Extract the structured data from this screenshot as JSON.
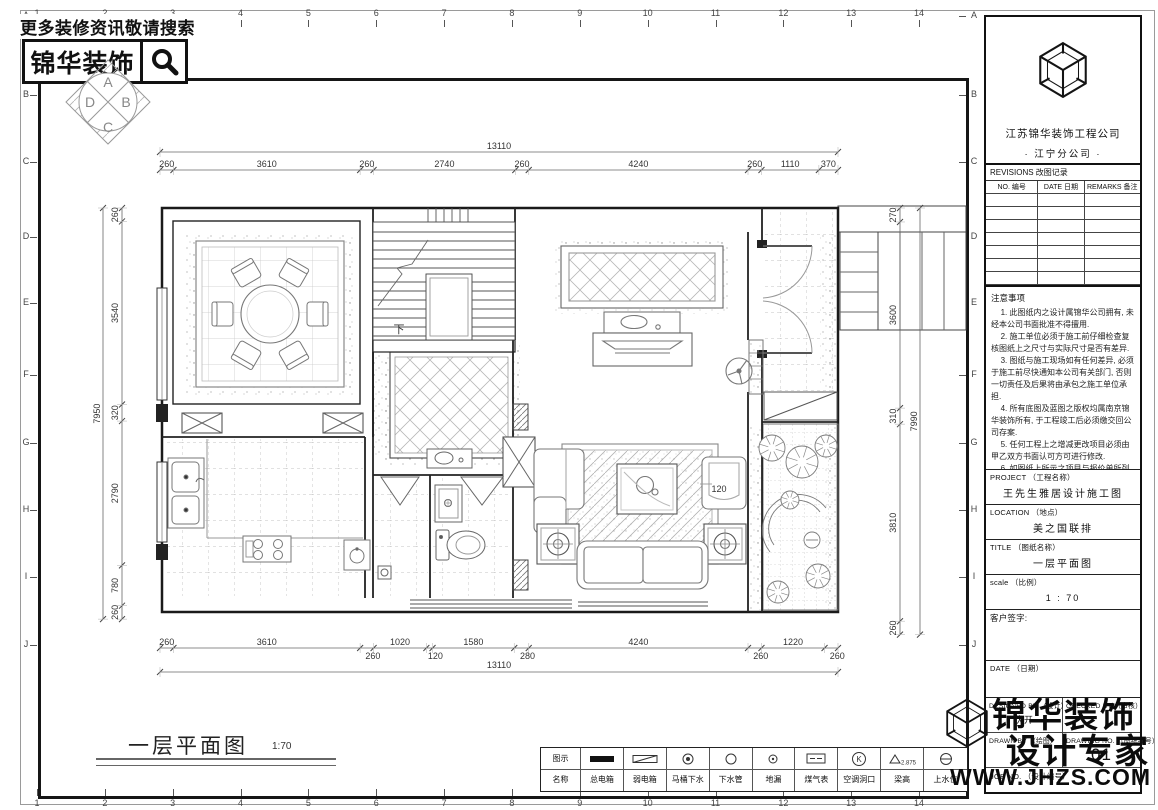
{
  "banner": {
    "tagline": "更多装修资讯敬请搜索",
    "brand": "锦华装饰"
  },
  "compass": {
    "top": "A",
    "right": "B",
    "bottom": "C",
    "left": "D"
  },
  "ruler": {
    "numbers": [
      "1",
      "2",
      "3",
      "4",
      "5",
      "6",
      "7",
      "8",
      "9",
      "10",
      "11",
      "12",
      "13",
      "14"
    ],
    "letters": [
      "A",
      "B",
      "C",
      "D",
      "E",
      "F",
      "G",
      "H",
      "I",
      "J"
    ]
  },
  "plan": {
    "caption": "一层平面图",
    "caption_scale": "1:70",
    "stairs_label": "下",
    "garden_dim": "120",
    "dims": {
      "top_total": "13110",
      "top": [
        "260",
        "3610",
        "260",
        "2740",
        "260",
        "4240",
        "260",
        "1110",
        "370"
      ],
      "bottom": [
        "260",
        "3610",
        "260",
        "1020",
        "120",
        "1580",
        "280",
        "4240",
        "260",
        "1220",
        "260"
      ],
      "bottom_total": "13110",
      "left_total": "7950",
      "left": [
        "260",
        "3540",
        "320",
        "2790",
        "780",
        "260"
      ],
      "right_total": "7990",
      "right": [
        "270",
        "3600",
        "310",
        "3810",
        "260"
      ]
    }
  },
  "legend": {
    "row1_label": "图示",
    "row2_label": "名称",
    "items": [
      {
        "icon": "main-power-box",
        "label": "总电箱"
      },
      {
        "icon": "weak-power-box",
        "label": "弱电箱"
      },
      {
        "icon": "toilet-drain",
        "label": "马桶下水"
      },
      {
        "icon": "drain-pipe",
        "label": "下水管"
      },
      {
        "icon": "floor-drain",
        "label": "地漏"
      },
      {
        "icon": "gas-meter",
        "label": "煤气表"
      },
      {
        "icon": "ac-opening",
        "label": "空调洞口",
        "symbol_letter": "K"
      },
      {
        "icon": "beam-height",
        "label": "梁高",
        "symbol_value": "2.875"
      },
      {
        "icon": "water-supply",
        "label": "上水位"
      }
    ]
  },
  "titleblock": {
    "company": "江苏锦华装饰工程公司",
    "branch": "·  江宁分公司  ·",
    "revisions_title": "REVISIONS 改图记录",
    "revisions_headers": [
      "NO. 编号",
      "DATE 日期",
      "REMARKS 备注"
    ],
    "revisions_empty_rows": 7,
    "notes_title": "注意事项",
    "notes": [
      "1. 此图纸内之设计属锦华公司拥有, 未经本公司书面批准不得擅用.",
      "2. 施工单位必须于施工前仔细检查复核图纸上之尺寸与实际尺寸是否有差异.",
      "3. 图纸与施工现场如有任何差异, 必须于施工前尽快通知本公司有关部门, 否则一切责任及后果将由承包之施工单位承担.",
      "4. 所有底图及蓝图之版权均属南京锦华装饰所有, 于工程竣工后必须缴交回公司存案.",
      "5. 任何工程上之增减更改项目必须由甲乙双方书面认可方可进行修改.",
      "6. 如图纸上所示之项目与报价单所列的项目有不符时, 以报价单或合同为准.",
      "7. 不得量度图纸."
    ],
    "project_label": "PROJECT （工程名称）",
    "project_value": "王先生雅居设计施工图",
    "location_label": "LOCATION （地点）",
    "location_value": "美之国联排",
    "title_label": "TITLE （图纸名称）",
    "title_value": "一层平面图",
    "scale_label": "scale （比例）",
    "scale_value": "1  :  70",
    "client_sign_label": "客户签字:",
    "date_label": "DATE （日期）",
    "designed_label": "DESIGNED BY （设计）",
    "designed_value": "伏开",
    "checked_label": "CHECKED BY （审核）",
    "drawn_label": "DRAWN BY （绘图）",
    "drawing_no_label": "DRAWING NO. （图纸编号）",
    "drawing_no_value": "01",
    "job_no_label": "JOB NO. （设计编号）"
  },
  "watermark": {
    "line1": "锦华装饰",
    "line2": "设计专家",
    "url": "WWW.JHZS.COM"
  }
}
